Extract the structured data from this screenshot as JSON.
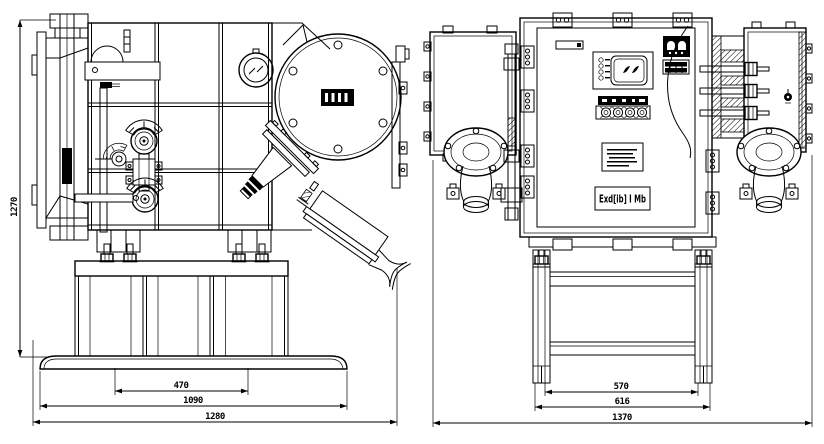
{
  "drawing": {
    "background_color": "#ffffff",
    "line_color": "#000000",
    "front_view": {
      "dimensions": {
        "height": "1270",
        "anchor_spacing": "470",
        "skid_width": "1090",
        "overall_width": "1280"
      }
    },
    "side_view": {
      "dimensions": {
        "leg_spacing": "570",
        "frame_width": "616",
        "overall_width": "1370"
      },
      "marking_label": "Exd[ib] I Mb"
    }
  }
}
